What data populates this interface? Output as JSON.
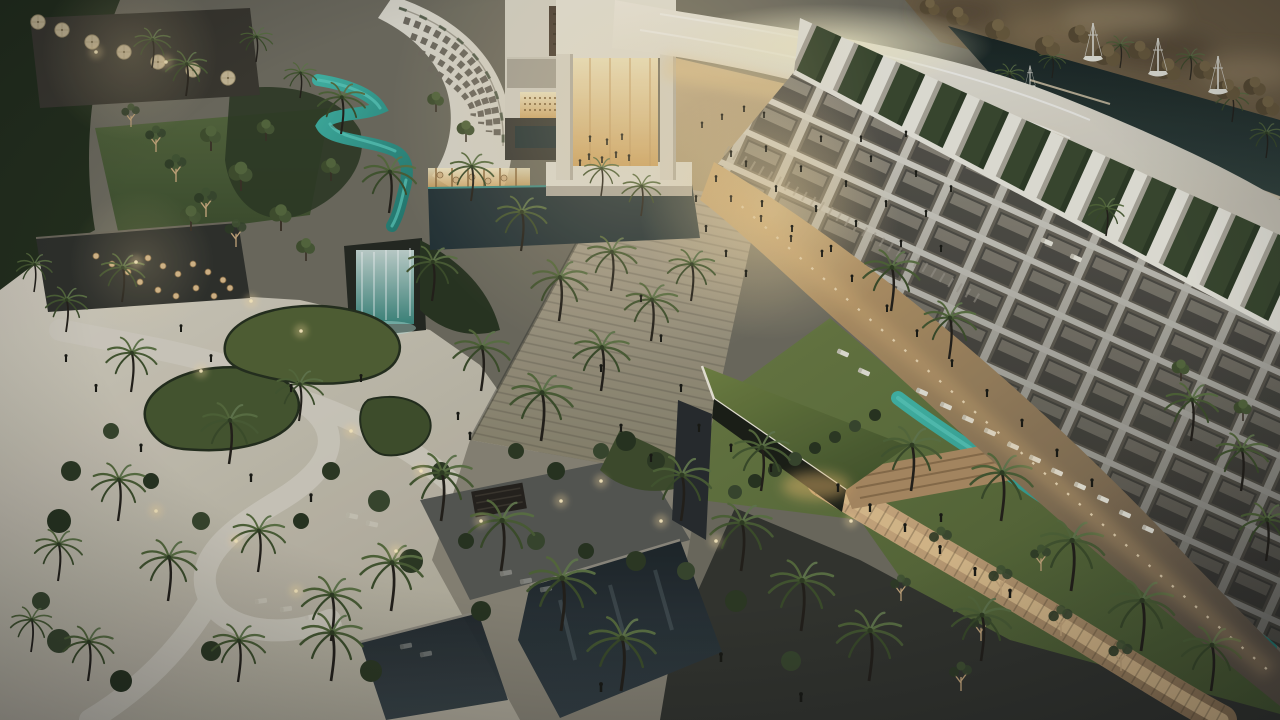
{
  "meta": {
    "description": "Dusk aerial rendering of a luxury resort: curved white hotel wings with balcony grids and rooftop privacy fins over green strips, a glowing golden atrium lobby under a sweeping white canopy, a palm-lined stone promenade with crowds, a turquoise lazy river through lawns with sun loungers, organic garden beds on a sandy plaza, dark reflecting pools, warm-lit terraces and a marina with white sailboats."
  },
  "palette": {
    "building_white": "#ddd8cb",
    "canopy_white": "#ece8dc",
    "warm_glow": "#f2dba6",
    "glow_deep": "#cc9a58",
    "lawn_green": "#5b6b38",
    "vegetation_dark": "#2a341f",
    "palm_green": "#4f6234",
    "river_teal": "#2f9f90",
    "river_highlight": "#5ecdbd",
    "pool_dark": "#212a2d",
    "sand_paving": "#cfc8b7",
    "path_light": "#d8d2c3",
    "stone_paving": "#a59e8e",
    "warm_paving": "#c9a878",
    "dark_paving": "#33332c",
    "marina_water": "#1e2a26",
    "marina_trees": "#6b5a3e",
    "person_dark": "#17160f",
    "light_warm": "#ffdf9e"
  },
  "scene": {
    "palms": [
      [
        152,
        68,
        0.62
      ],
      [
        186,
        96,
        0.7
      ],
      [
        256,
        62,
        0.55
      ],
      [
        300,
        98,
        0.55
      ],
      [
        341,
        134,
        0.8
      ],
      [
        389,
        213,
        0.9
      ],
      [
        34,
        292,
        0.6
      ],
      [
        66,
        332,
        0.7
      ],
      [
        122,
        302,
        0.75
      ],
      [
        131,
        392,
        0.85
      ],
      [
        229,
        464,
        0.95
      ],
      [
        299,
        421,
        0.8
      ],
      [
        118,
        521,
        0.9
      ],
      [
        58,
        581,
        0.8
      ],
      [
        168,
        601,
        0.95
      ],
      [
        258,
        572,
        0.9
      ],
      [
        331,
        641,
        1
      ],
      [
        238,
        682,
        0.9
      ],
      [
        88,
        681,
        0.85
      ],
      [
        31,
        652,
        0.7
      ],
      [
        432,
        301,
        0.85
      ],
      [
        471,
        201,
        0.75
      ],
      [
        521,
        251,
        0.85
      ],
      [
        559,
        321,
        0.95
      ],
      [
        481,
        391,
        0.95
      ],
      [
        541,
        441,
        1.05
      ],
      [
        601,
        391,
        0.95
      ],
      [
        611,
        291,
        0.85
      ],
      [
        651,
        341,
        0.9
      ],
      [
        691,
        301,
        0.8
      ],
      [
        601,
        196,
        0.6
      ],
      [
        641,
        216,
        0.65
      ],
      [
        441,
        521,
        1.05
      ],
      [
        501,
        571,
        1.1
      ],
      [
        391,
        611,
        1.05
      ],
      [
        331,
        681,
        1.05
      ],
      [
        561,
        631,
        1.15
      ],
      [
        621,
        691,
        1.15
      ],
      [
        681,
        521,
        1
      ],
      [
        741,
        571,
        1.05
      ],
      [
        801,
        631,
        1.1
      ],
      [
        869,
        681,
        1.1
      ],
      [
        761,
        491,
        0.95
      ],
      [
        891,
        311,
        0.95
      ],
      [
        949,
        359,
        0.9
      ],
      [
        911,
        491,
        1
      ],
      [
        1001,
        521,
        1.05
      ],
      [
        1071,
        591,
        1.1
      ],
      [
        1141,
        651,
        1.1
      ],
      [
        981,
        661,
        1
      ],
      [
        1191,
        441,
        0.9
      ],
      [
        1241,
        491,
        0.9
      ],
      [
        1266,
        561,
        0.9
      ],
      [
        1211,
        691,
        1
      ],
      [
        1106,
        236,
        0.6
      ]
    ],
    "marina_palms": [
      [
        1009,
        96,
        0.5
      ],
      [
        1232,
        122,
        0.55
      ],
      [
        1266,
        158,
        0.55
      ],
      [
        1052,
        78,
        0.45
      ],
      [
        1120,
        68,
        0.5
      ],
      [
        1190,
        80,
        0.5
      ]
    ],
    "people": [
      [
        589,
        160
      ],
      [
        602,
        163
      ],
      [
        616,
        158
      ],
      [
        629,
        161
      ],
      [
        580,
        166
      ],
      [
        590,
        142
      ],
      [
        607,
        145
      ],
      [
        622,
        140
      ],
      [
        702,
        128
      ],
      [
        722,
        120
      ],
      [
        744,
        112
      ],
      [
        764,
        118
      ],
      [
        716,
        182
      ],
      [
        731,
        202
      ],
      [
        746,
        167
      ],
      [
        761,
        222
      ],
      [
        776,
        192
      ],
      [
        791,
        242
      ],
      [
        801,
        172
      ],
      [
        816,
        212
      ],
      [
        831,
        252
      ],
      [
        846,
        187
      ],
      [
        856,
        227
      ],
      [
        871,
        162
      ],
      [
        886,
        207
      ],
      [
        901,
        247
      ],
      [
        916,
        177
      ],
      [
        926,
        217
      ],
      [
        941,
        252
      ],
      [
        951,
        192
      ],
      [
        731,
        157
      ],
      [
        766,
        152
      ],
      [
        821,
        142
      ],
      [
        861,
        142
      ],
      [
        906,
        137
      ],
      [
        706,
        232
      ],
      [
        726,
        257
      ],
      [
        746,
        277
      ],
      [
        696,
        202
      ],
      [
        762,
        207
      ],
      [
        792,
        232
      ],
      [
        822,
        257
      ],
      [
        852,
        282
      ],
      [
        887,
        312
      ],
      [
        917,
        337
      ],
      [
        952,
        367
      ],
      [
        987,
        397
      ],
      [
        1022,
        427
      ],
      [
        1057,
        457
      ],
      [
        1092,
        487
      ],
      [
        641,
        302
      ],
      [
        661,
        342
      ],
      [
        681,
        392
      ],
      [
        699,
        432
      ],
      [
        651,
        462
      ],
      [
        621,
        432
      ],
      [
        601,
        372
      ],
      [
        181,
        332
      ],
      [
        211,
        362
      ],
      [
        291,
        392
      ],
      [
        361,
        382
      ],
      [
        251,
        482
      ],
      [
        311,
        502
      ],
      [
        141,
        452
      ],
      [
        66,
        362
      ],
      [
        96,
        392
      ],
      [
        601,
        692
      ],
      [
        721,
        662
      ],
      [
        801,
        702
      ],
      [
        941,
        522
      ],
      [
        838,
        492
      ],
      [
        870,
        512
      ],
      [
        905,
        532
      ],
      [
        940,
        554
      ],
      [
        975,
        576
      ],
      [
        1010,
        598
      ],
      [
        731,
        452
      ],
      [
        771,
        472
      ],
      [
        458,
        420
      ],
      [
        470,
        440
      ]
    ],
    "loungers_white": [
      [
        922,
        392,
        24
      ],
      [
        946,
        406,
        24
      ],
      [
        968,
        419,
        24
      ],
      [
        990,
        432,
        24
      ],
      [
        1013,
        446,
        24
      ],
      [
        1035,
        459,
        24
      ],
      [
        1057,
        472,
        24
      ],
      [
        1080,
        486,
        24
      ],
      [
        1103,
        499,
        24
      ],
      [
        1125,
        514,
        24
      ],
      [
        1148,
        529,
        24
      ],
      [
        864,
        372,
        24
      ],
      [
        843,
        353,
        24
      ],
      [
        1047,
        242,
        24
      ],
      [
        1076,
        258,
        24
      ]
    ],
    "loungers_dark": [
      [
        261,
        601,
        -8
      ],
      [
        286,
        609,
        -8
      ],
      [
        311,
        617,
        -8
      ],
      [
        336,
        625,
        -8
      ],
      [
        506,
        573,
        -10
      ],
      [
        526,
        581,
        -10
      ],
      [
        546,
        589,
        -10
      ],
      [
        406,
        646,
        -10
      ],
      [
        426,
        654,
        -10
      ],
      [
        352,
        516,
        12
      ],
      [
        372,
        524,
        12
      ]
    ],
    "boats": [
      [
        1093,
        57,
        1
      ],
      [
        1158,
        72,
        1
      ],
      [
        1218,
        90,
        1
      ],
      [
        1030,
        86,
        0.6
      ]
    ],
    "umbrellas": [
      [
        62,
        30
      ],
      [
        92,
        42
      ],
      [
        124,
        52
      ],
      [
        158,
        62
      ],
      [
        193,
        70
      ],
      [
        228,
        78
      ],
      [
        38,
        22
      ]
    ],
    "tables": [
      [
        148,
        258
      ],
      [
        163,
        266
      ],
      [
        178,
        274
      ],
      [
        193,
        264
      ],
      [
        208,
        272
      ],
      [
        223,
        280
      ],
      [
        140,
        282
      ],
      [
        158,
        290
      ],
      [
        176,
        296
      ],
      [
        196,
        288
      ],
      [
        214,
        296
      ],
      [
        230,
        288
      ],
      [
        96,
        256
      ],
      [
        112,
        264
      ],
      [
        128,
        272
      ],
      [
        440,
        175
      ],
      [
        456,
        180
      ],
      [
        472,
        177
      ],
      [
        488,
        181
      ],
      [
        504,
        178
      ]
    ],
    "trees_round": [
      [
        211,
        151,
        1
      ],
      [
        241,
        191,
        1.15
      ],
      [
        191,
        231,
        1
      ],
      [
        281,
        231,
        1.05
      ],
      [
        331,
        181,
        0.9
      ],
      [
        266,
        141,
        0.85
      ],
      [
        1181,
        381,
        0.85
      ],
      [
        1243,
        421,
        0.85
      ],
      [
        306,
        261,
        0.9
      ],
      [
        436,
        112,
        0.8
      ],
      [
        466,
        142,
        0.85
      ]
    ],
    "trees_marina": [
      [
        958,
        22,
        0.9
      ],
      [
        998,
        36,
        1
      ],
      [
        1048,
        52,
        1
      ],
      [
        1108,
        62,
        1.05
      ],
      [
        1168,
        76,
        1.05
      ],
      [
        1228,
        96,
        1
      ],
      [
        1268,
        112,
        0.95
      ],
      [
        930,
        12,
        0.8
      ],
      [
        1080,
        40,
        0.9
      ],
      [
        1140,
        56,
        0.9
      ],
      [
        1205,
        76,
        0.9
      ],
      [
        1255,
        92,
        0.9
      ]
    ],
    "trees_bare": [
      [
        941,
        556,
        1
      ],
      [
        1001,
        596,
        1.05
      ],
      [
        1061,
        636,
        1.05
      ],
      [
        1121,
        671,
        1.05
      ],
      [
        981,
        641,
        0.95
      ],
      [
        901,
        601,
        0.9
      ],
      [
        961,
        691,
        1
      ],
      [
        1041,
        571,
        0.9
      ],
      [
        156,
        152,
        0.9
      ],
      [
        176,
        182,
        0.95
      ],
      [
        206,
        217,
        1
      ],
      [
        236,
        247,
        0.95
      ],
      [
        131,
        127,
        0.8
      ]
    ],
    "bushes": [
      [
        71,
        471,
        10
      ],
      [
        111,
        431,
        8
      ],
      [
        59,
        521,
        12
      ],
      [
        331,
        471,
        9
      ],
      [
        379,
        501,
        11
      ],
      [
        301,
        521,
        8
      ],
      [
        411,
        561,
        12
      ],
      [
        201,
        521,
        9
      ],
      [
        151,
        481,
        8
      ],
      [
        441,
        471,
        9
      ],
      [
        59,
        641,
        12
      ],
      [
        121,
        681,
        11
      ],
      [
        211,
        651,
        10
      ],
      [
        41,
        601,
        9
      ],
      [
        481,
        611,
        10
      ],
      [
        371,
        671,
        11
      ],
      [
        536,
        541,
        9
      ],
      [
        586,
        551,
        8
      ],
      [
        636,
        561,
        10
      ],
      [
        686,
        571,
        9
      ],
      [
        466,
        541,
        8
      ],
      [
        736,
        601,
        11
      ],
      [
        791,
        661,
        10
      ],
      [
        626,
        441,
        10
      ],
      [
        656,
        461,
        9
      ],
      [
        601,
        451,
        8
      ],
      [
        556,
        471,
        9
      ],
      [
        516,
        451,
        8
      ],
      [
        735,
        492,
        7
      ],
      [
        755,
        481,
        7
      ],
      [
        775,
        470,
        7
      ],
      [
        795,
        459,
        7
      ],
      [
        815,
        448,
        6
      ],
      [
        835,
        437,
        6
      ],
      [
        855,
        426,
        6
      ],
      [
        875,
        415,
        6
      ]
    ],
    "lights": [
      [
        301,
        331
      ],
      [
        251,
        301
      ],
      [
        201,
        371
      ],
      [
        351,
        431
      ],
      [
        421,
        471
      ],
      [
        601,
        481
      ],
      [
        661,
        521
      ],
      [
        481,
        521
      ],
      [
        561,
        501
      ],
      [
        716,
        541
      ],
      [
        851,
        521
      ],
      [
        236,
        541
      ],
      [
        156,
        511
      ],
      [
        396,
        551
      ],
      [
        296,
        591
      ],
      [
        136,
        262
      ],
      [
        96,
        52
      ],
      [
        166,
        62
      ]
    ]
  }
}
